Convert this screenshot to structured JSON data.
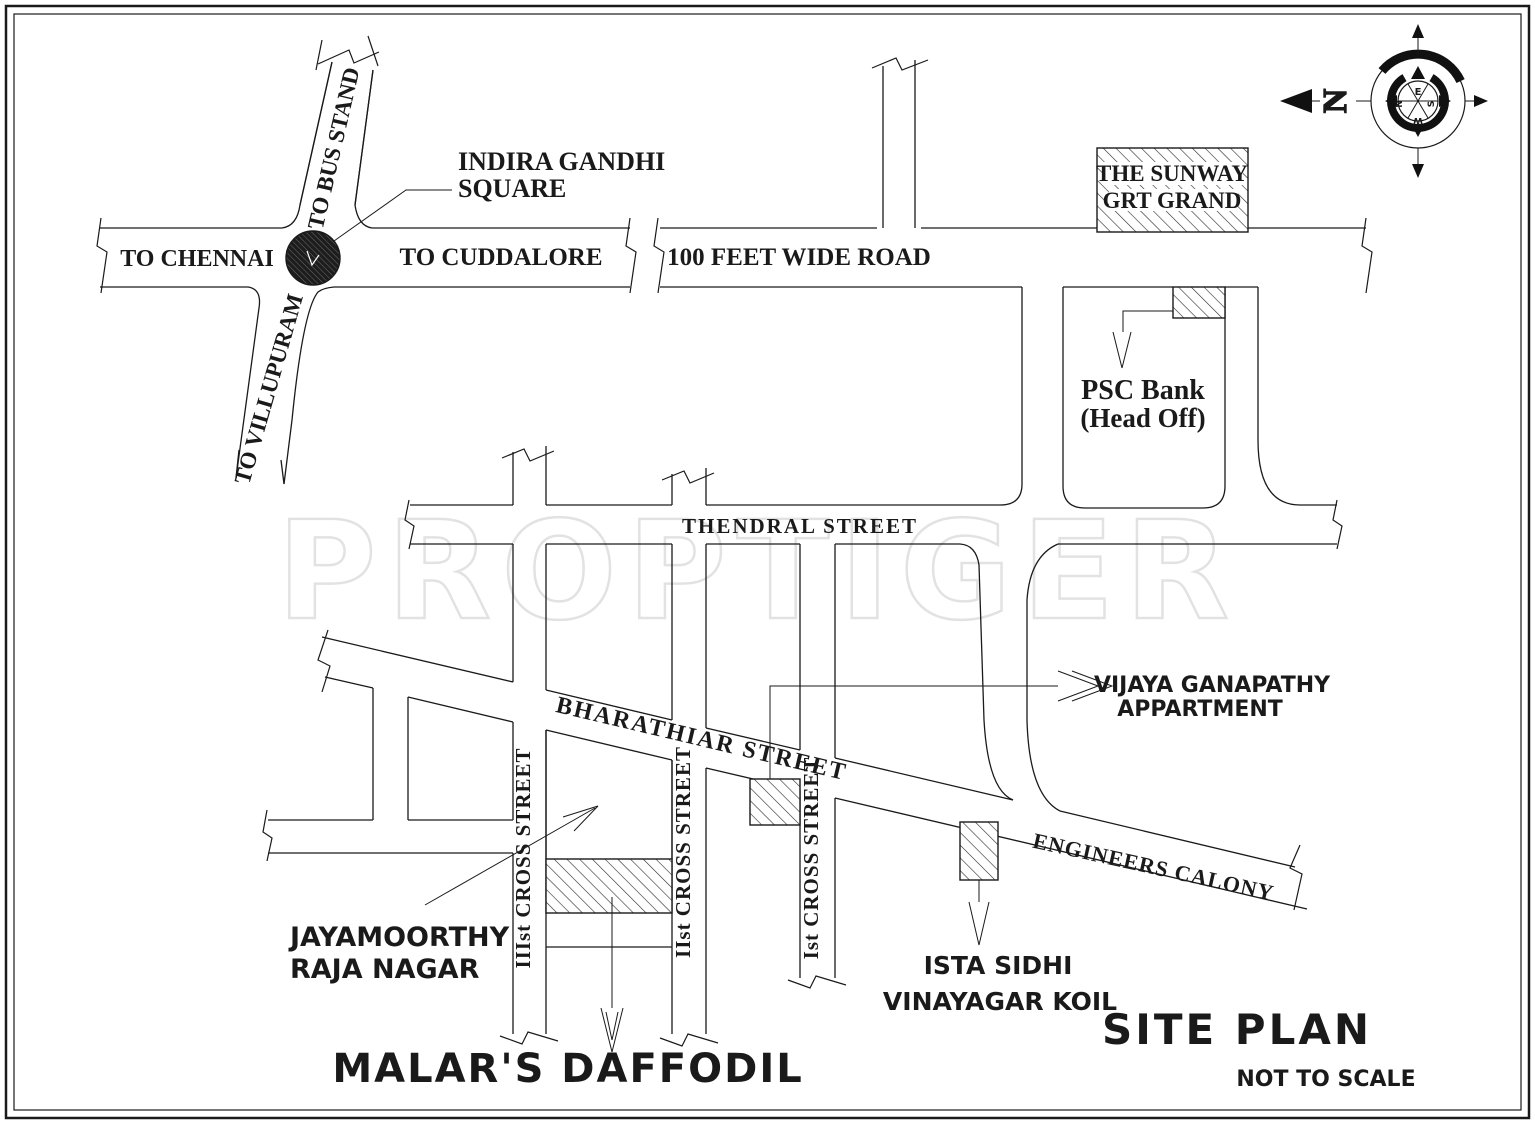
{
  "watermark": "PROPTIGER",
  "titleblock": {
    "site_plan": "SITE PLAN",
    "not_to_scale": "NOT TO SCALE",
    "project": "MALAR'S DAFFODIL"
  },
  "roads": {
    "to_chennai": "TO CHENNAI",
    "to_cuddalore": "TO CUDDALORE",
    "hundred_feet": "100 FEET WIDE ROAD",
    "to_bus_stand": "TO BUS STAND",
    "to_villupuram": "TO VILLUPURAM",
    "thendral": "THENDRAL  STREET",
    "bharathiar": "BHARATHIAR  STREET",
    "engineers": "ENGINEERS CALONY",
    "cross_3": "IIIst  CROSS STREET",
    "cross_2": "IIst  CROSS STREET",
    "cross_1": "Ist  CROSS STREET"
  },
  "landmarks": {
    "indira_line1": "INDIRA GANDHI",
    "indira_line2": "SQUARE",
    "sunway_line1": "THE SUNWAY",
    "sunway_line2": "GRT GRAND",
    "psc_line1": "PSC Bank",
    "psc_line2": "(Head Off)",
    "vijaya_line1": "VIJAYA GANAPATHY",
    "vijaya_line2": "APPARTMENT",
    "jaya_line1": "JAYAMOORTHY",
    "jaya_line2": "RAJA NAGAR",
    "ista_line1": "ISTA SIDHI",
    "ista_line2": "VINAYAGAR KOIL"
  },
  "compass": {
    "north": "N",
    "east": "E",
    "west": "W",
    "south": "S"
  },
  "colors": {
    "line": "#1a1a1a",
    "watermark": "#e2e2e2",
    "paper": "#ffffff"
  }
}
